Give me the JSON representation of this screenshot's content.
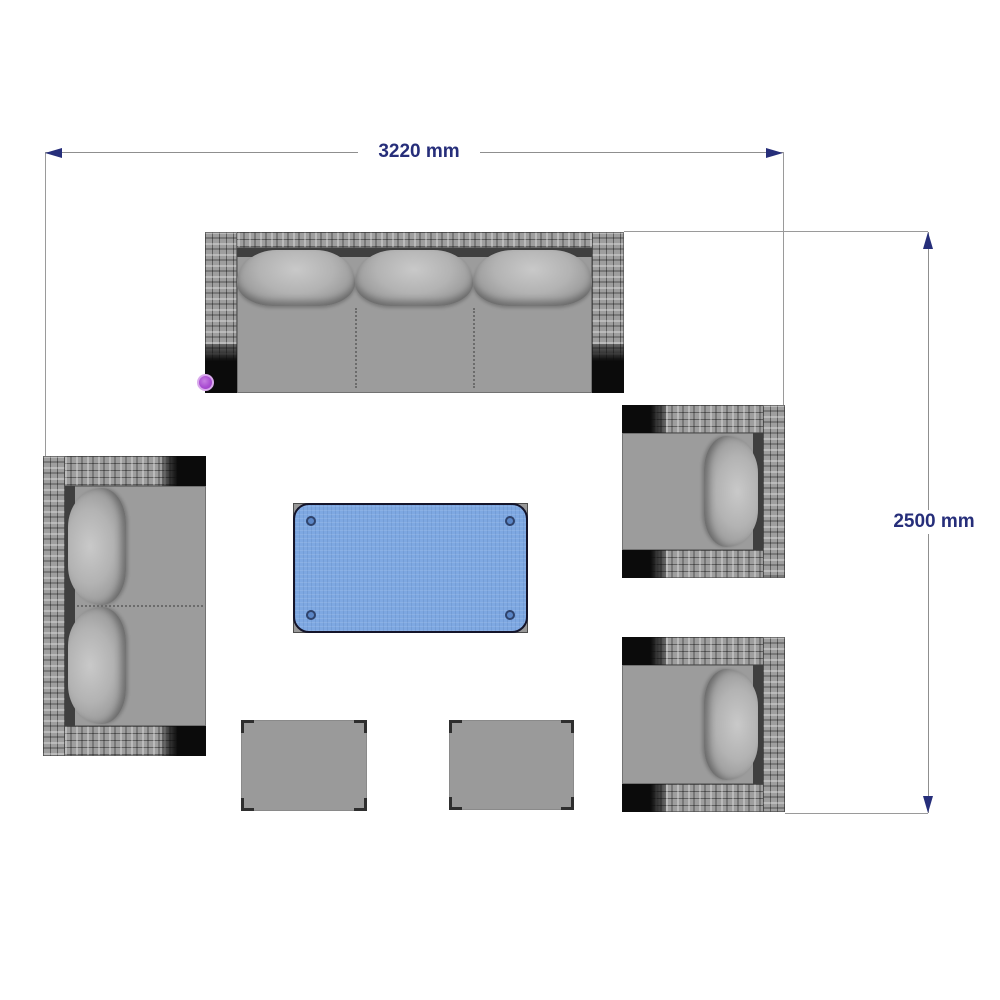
{
  "diagram": {
    "type": "furniture-layout-top-view",
    "dimensions": {
      "width_label": "3220 mm",
      "height_label": "2500 mm"
    },
    "colors": {
      "background": "#ffffff",
      "dimension_text": "#262e7a",
      "dimension_arrow": "#262e7a",
      "dimension_line": "#8f8f8f",
      "frame_wicker_gray": "#9e9e9e",
      "seat_gray": "#9c9c9c",
      "cushion_gray": "#b3b3b3",
      "back_strip_dark": "#3f3f3f",
      "arm_end_black": "#0b0b0b",
      "table_glass_blue": "#7ea8e2",
      "table_bolt_blue": "#5b86c6",
      "selection_handle_purple": "#aa4ed2"
    },
    "items": [
      {
        "id": "sofa-3-seater",
        "cushions": 3
      },
      {
        "id": "loveseat-2-seater",
        "cushions": 2
      },
      {
        "id": "armchair-upper",
        "cushions": 1
      },
      {
        "id": "armchair-lower",
        "cushions": 1
      },
      {
        "id": "coffee-table-glass-top"
      },
      {
        "id": "footstool-left"
      },
      {
        "id": "footstool-right"
      }
    ]
  }
}
